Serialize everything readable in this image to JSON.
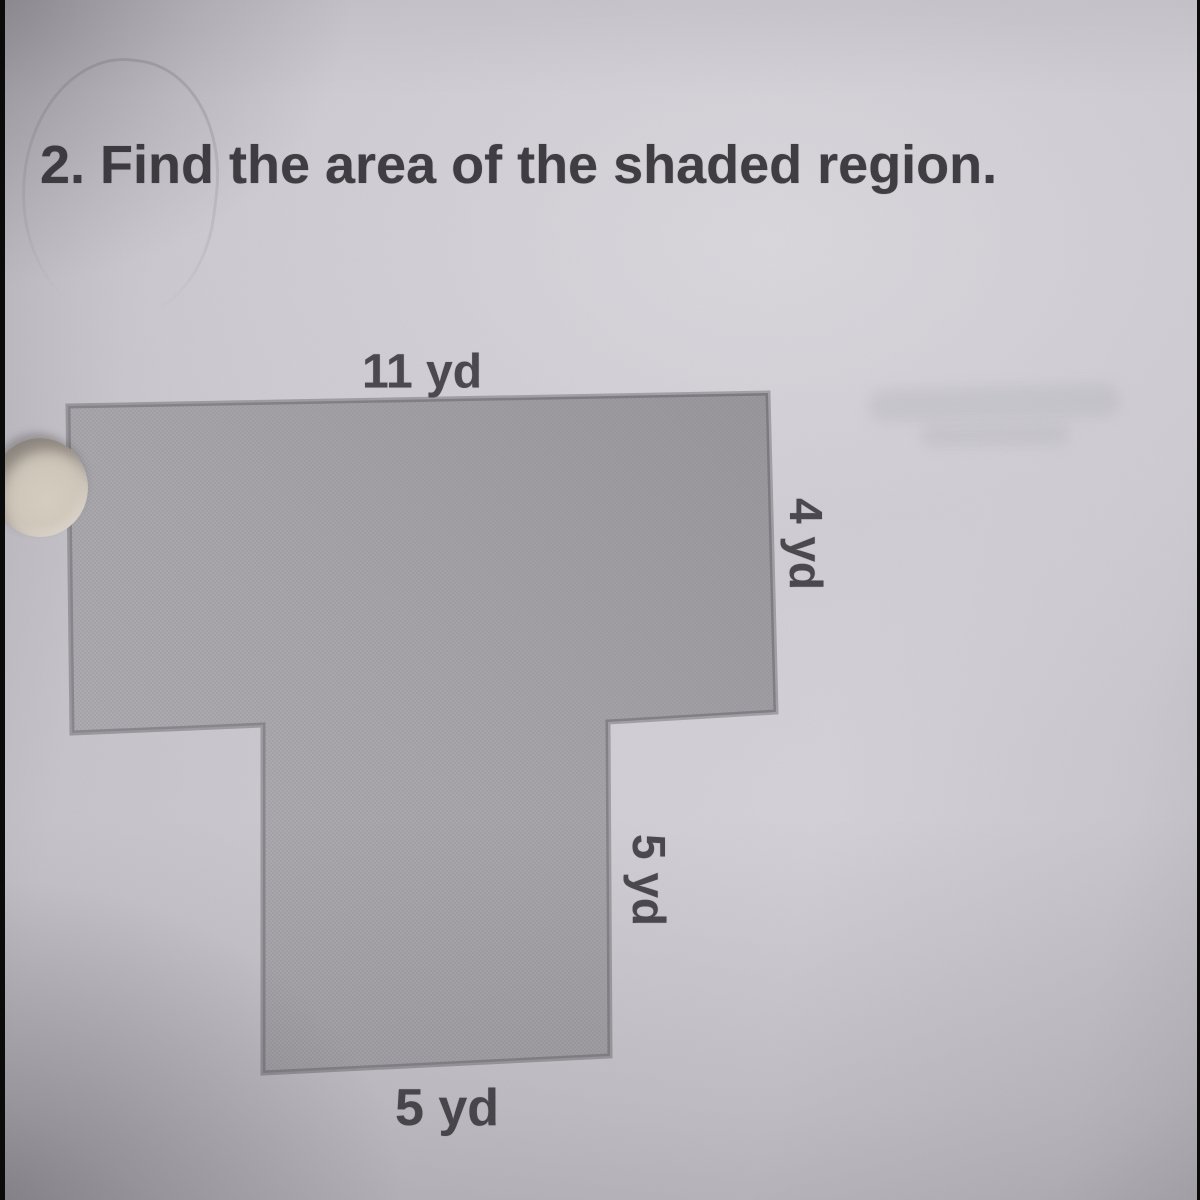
{
  "title": "2. Find the area of the shaded region.",
  "diagram": {
    "shape": "T-shaped shaded polygon",
    "labels": {
      "top": "11 yd",
      "right": "4 yd",
      "stem_right": "5 yd",
      "bottom": "5 yd"
    }
  },
  "colors": {
    "paper": "#cdcbd1",
    "shape_fill": "#a5a3a8",
    "shape_outline": "#3e3c40",
    "title_ink": "#3b393e",
    "label_ink": "#47454a"
  }
}
